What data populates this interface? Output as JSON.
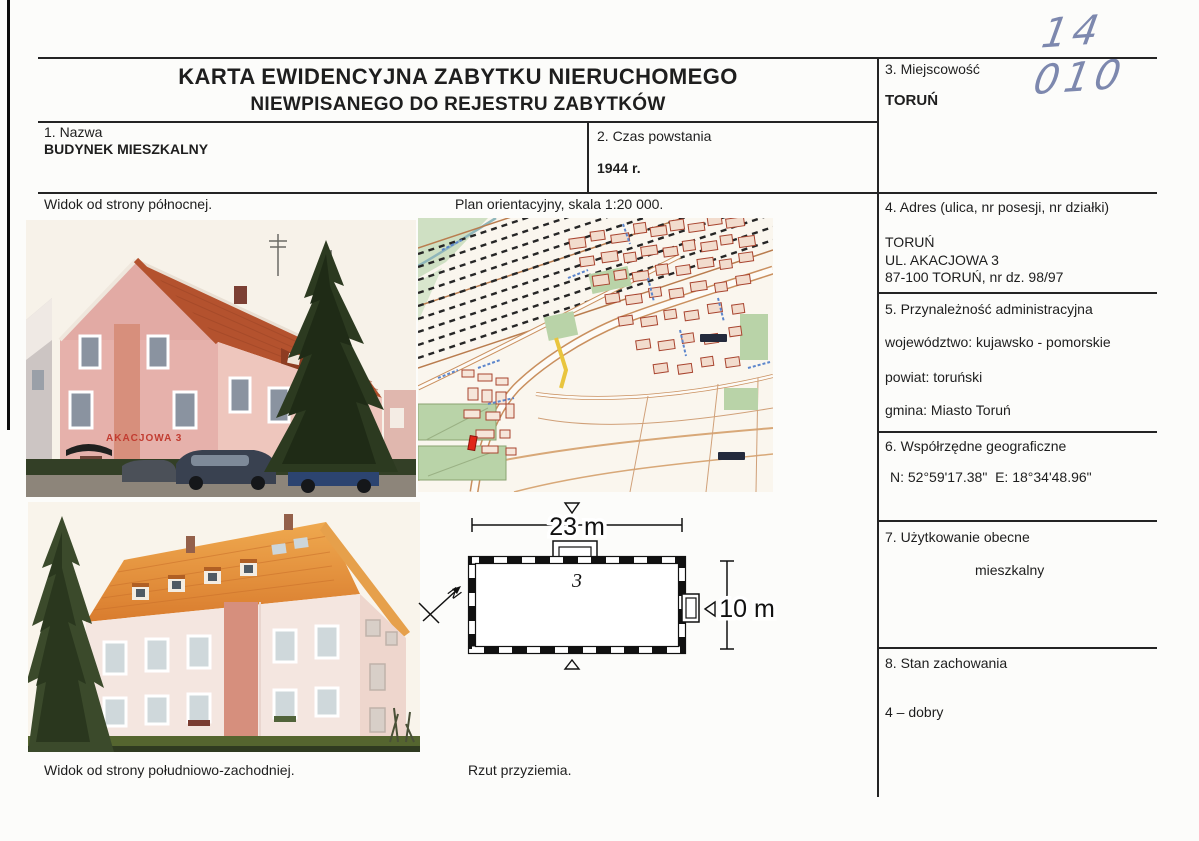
{
  "page": {
    "inventory_number": "14 010",
    "title_line1": "KARTA EWIDENCYJNA ZABYTKU NIERUCHOMEGO",
    "title_line2": "NIEWPISANEGO DO REJESTRU ZABYTKÓW"
  },
  "fields": {
    "f1": {
      "label": "1. Nazwa",
      "value": "BUDYNEK MIESZKALNY"
    },
    "f2": {
      "label": "2. Czas powstania",
      "value": "1944 r."
    },
    "f3": {
      "label": "3. Miejscowość",
      "value": "TORUŃ"
    },
    "f4": {
      "label": "4. Adres (ulica, nr posesji, nr działki)",
      "line1": "TORUŃ",
      "line2": "UL. AKACJOWA 3",
      "line3": "87-100 TORUŃ, nr dz. 98/97"
    },
    "f5": {
      "label": "5. Przynależność administracyjna",
      "voivodeship": "województwo: kujawsko - pomorskie",
      "county": "powiat: toruński",
      "commune": "gmina: Miasto Toruń"
    },
    "f6": {
      "label": "6. Współrzędne geograficzne",
      "value": "N: 52°59'17.38\"  E: 18°34'48.96\""
    },
    "f7": {
      "label": "7. Użytkowanie obecne",
      "value": "mieszkalny"
    },
    "f8": {
      "label": "8. Stan zachowania",
      "value": "4 – dobry"
    }
  },
  "captions": {
    "photo_north": "Widok od strony północnej.",
    "site_plan": "Plan orientacyjny, skala 1:20 000.",
    "photo_southwest": "Widok od strony południowo-zachodniej.",
    "ground_plan": "Rzut przyziemia."
  },
  "floor_plan": {
    "width_label": "23 m",
    "height_label": "10 m",
    "unit_number": "3",
    "north_letter": "N"
  },
  "photo": {
    "building_sign": "AKACJOWA 3"
  },
  "colors": {
    "handwriting": "#7d88ae",
    "table_line": "#242424",
    "roof_north_view": "#b4522e",
    "roof_southwest_view": "#e0893a",
    "wall_pink": "#e6b1ab",
    "map_highlight_building": "#e02818"
  }
}
